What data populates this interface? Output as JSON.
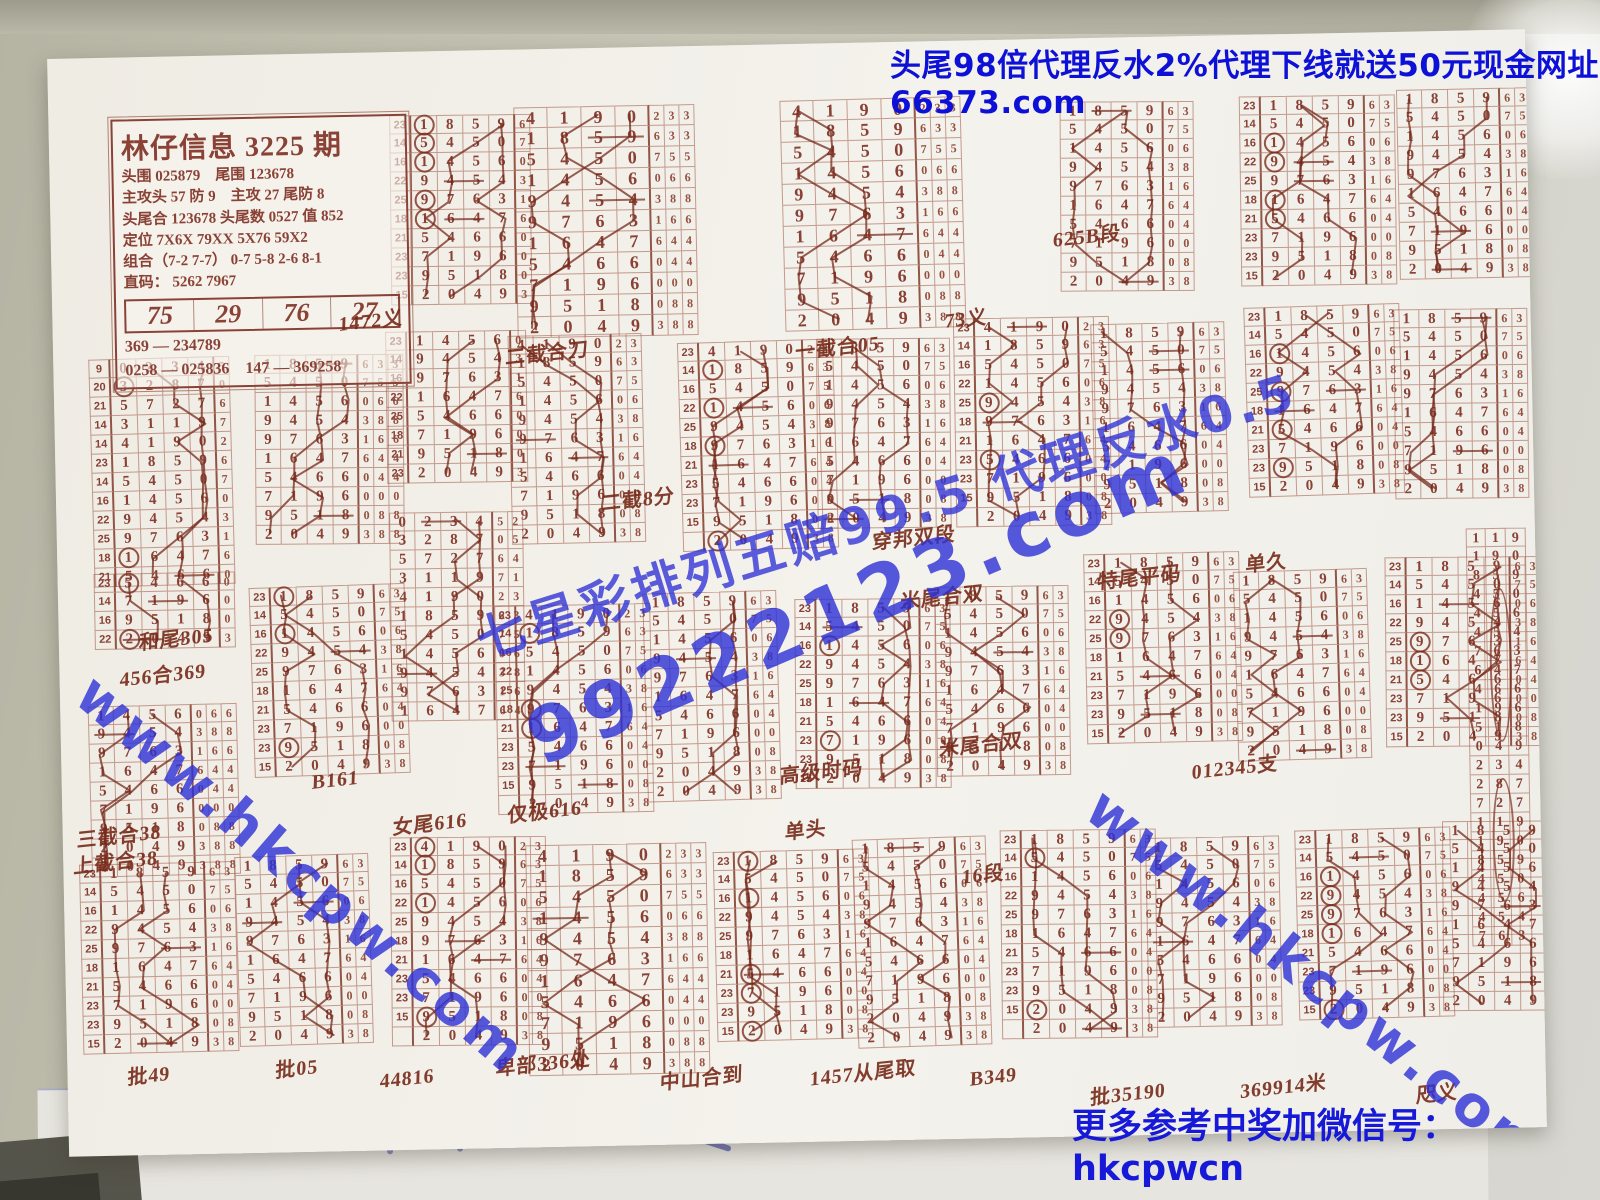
{
  "ad_banner": {
    "text": "头尾98倍代理反水2%代理下线就送50元现金网址66373.com",
    "color": "#0d10d6"
  },
  "footer": {
    "text": "更多参考中奖加微信号：hkcpwcn",
    "color": "#161ad8"
  },
  "watermarks": [
    {
      "name": "promo-odds",
      "text": "七星彩排列五赔99.5 代理反水0.5",
      "color": "#2e31d6"
    },
    {
      "name": "site-number",
      "text": "99222123.com",
      "color": "#2e31d6"
    },
    {
      "name": "site-left",
      "text": "www.hkcpw.com",
      "color": "#2e31d6"
    },
    {
      "name": "site-right",
      "text": "www.hkcpw.com",
      "color": "#2e31d6"
    }
  ],
  "info_box": {
    "title": "林仔信息 3225 期",
    "lines": [
      "头围 025879　尾围 123678",
      "主攻头 57 防 9　主攻 27 尾防 8",
      "头尾合 123678 头尾数 0527 值 852",
      "定位 7X6X  79XX  5X76  59X2",
      "组合（7-2 7-7） 0-7 5-8 2-6 8-1",
      "直码： 5262  7967"
    ],
    "row_numbers": [
      "75",
      "29",
      "76",
      "27"
    ],
    "footer_lines": [
      "369 — 234789",
      "0258 — 025836　147 — 369258"
    ]
  },
  "under_sheet": {
    "faint_digits": "5 5 5 5"
  },
  "chart": {
    "ink_color": "#8a4135",
    "hand_color": "#76291b",
    "row_labels": [
      "23",
      "14",
      "16",
      "22",
      "25",
      "18",
      "21",
      "23",
      "23",
      "15"
    ],
    "extended_labels": [
      "9",
      "20",
      "21",
      "14",
      "14",
      "23",
      "14",
      "16",
      "22",
      "25",
      "18",
      "21"
    ],
    "sequence": [
      {
        "d": [
          "0",
          "2",
          "3",
          "4"
        ],
        "t": [
          "5",
          "2"
        ]
      },
      {
        "d": [
          "3",
          "2",
          "8",
          "7"
        ],
        "t": [
          "0",
          "5"
        ]
      },
      {
        "d": [
          "5",
          "7",
          "2",
          "7"
        ],
        "t": [
          "6",
          "4"
        ]
      },
      {
        "d": [
          "3",
          "1",
          "1",
          "9"
        ],
        "t": [
          "7",
          "1"
        ]
      },
      {
        "d": [
          "4",
          "1",
          "9",
          "0"
        ],
        "t": [
          "2",
          "3"
        ]
      },
      {
        "d": [
          "1",
          "8",
          "5",
          "9"
        ],
        "t": [
          "6",
          "3"
        ]
      },
      {
        "d": [
          "5",
          "4",
          "5",
          "0"
        ],
        "t": [
          "7",
          "5"
        ]
      },
      {
        "d": [
          "1",
          "4",
          "5",
          "6"
        ],
        "t": [
          "0",
          "6"
        ]
      },
      {
        "d": [
          "9",
          "4",
          "5",
          "4"
        ],
        "t": [
          "3",
          "8"
        ]
      },
      {
        "d": [
          "9",
          "7",
          "6",
          "3"
        ],
        "t": [
          "1",
          "6"
        ]
      },
      {
        "d": [
          "1",
          "6",
          "4",
          "7"
        ],
        "t": [
          "6",
          "4"
        ]
      },
      {
        "d": [
          "5",
          "4",
          "6",
          "6"
        ],
        "t": [
          "0",
          "4"
        ]
      },
      {
        "d": [
          "7",
          "1",
          "9",
          "6"
        ],
        "t": [
          "0",
          "0"
        ]
      },
      {
        "d": [
          "9",
          "5",
          "1",
          "8"
        ],
        "t": [
          "0",
          "8"
        ]
      },
      {
        "d": [
          "2",
          "0",
          "4",
          "9"
        ],
        "t": [
          "3",
          "8",
          "8"
        ]
      }
    ],
    "blocks": [
      {
        "x": 340,
        "y": 64,
        "s": 5,
        "n": 10,
        "lab": 1,
        "tr": 1
      },
      {
        "x": 465,
        "y": 58,
        "s": 4,
        "n": 11,
        "tr": 3,
        "size": "L"
      },
      {
        "x": 732,
        "y": 56,
        "s": 4,
        "n": 11,
        "tr": 3,
        "size": "L"
      },
      {
        "x": 1010,
        "y": 64,
        "s": 5,
        "n": 10,
        "tr": 2
      },
      {
        "x": 1190,
        "y": 62,
        "s": 5,
        "n": 10,
        "lab": 1,
        "tr": 2
      },
      {
        "x": 1348,
        "y": 58,
        "s": 5,
        "n": 10,
        "tr": 2
      },
      {
        "x": 36,
        "y": 301,
        "s": 0,
        "n": 12,
        "lab": 1,
        "ext": 1,
        "tr": 1
      },
      {
        "x": 200,
        "y": 301,
        "s": 5,
        "n": 10,
        "tr": 3
      },
      {
        "x": 332,
        "y": 280,
        "s": 7,
        "n": 8,
        "lab": 1,
        "tr": 1
      },
      {
        "x": 455,
        "y": 286,
        "s": 4,
        "n": 11,
        "tr": 2
      },
      {
        "x": 625,
        "y": 296,
        "s": 4,
        "n": 11,
        "lab": 1,
        "tr": 2
      },
      {
        "x": 762,
        "y": 296,
        "s": 5,
        "n": 10,
        "tr": 2
      },
      {
        "x": 900,
        "y": 278,
        "s": 4,
        "n": 11,
        "lab": 1,
        "tr": 2
      },
      {
        "x": 1038,
        "y": 286,
        "s": 5,
        "n": 10,
        "tr": 2
      },
      {
        "x": 1192,
        "y": 272,
        "s": 5,
        "n": 10,
        "lab": 1,
        "tr": 2
      },
      {
        "x": 1340,
        "y": 278,
        "s": 5,
        "n": 10,
        "tr": 2
      },
      {
        "x": 36,
        "y": 516,
        "s": 11,
        "n": 4,
        "lab": 1,
        "tr": 1
      },
      {
        "x": 28,
        "y": 648,
        "s": 7,
        "n": 9,
        "tr": 3
      },
      {
        "x": 192,
        "y": 532,
        "s": 5,
        "n": 10,
        "lab": 1,
        "tr": 2
      },
      {
        "x": 332,
        "y": 461,
        "s": 0,
        "n": 11,
        "tr": 2
      },
      {
        "x": 436,
        "y": 556,
        "s": 4,
        "n": 11,
        "lab": 1,
        "tr": 2
      },
      {
        "x": 585,
        "y": 546,
        "s": 5,
        "n": 11,
        "tr": 2
      },
      {
        "x": 735,
        "y": 556,
        "s": 5,
        "n": 10,
        "lab": 1,
        "tr": 2
      },
      {
        "x": 876,
        "y": 546,
        "s": 5,
        "n": 10,
        "tr": 2
      },
      {
        "x": 1026,
        "y": 516,
        "s": 5,
        "n": 10,
        "lab": 1,
        "tr": 2
      },
      {
        "x": 1176,
        "y": 536,
        "s": 5,
        "n": 10,
        "tr": 2
      },
      {
        "x": 1326,
        "y": 526,
        "s": 5,
        "n": 10,
        "lab": 1,
        "tr": 2
      },
      {
        "type": "strip",
        "x": 1408,
        "y": 498,
        "n": 22
      },
      {
        "x": 16,
        "y": 806,
        "s": 5,
        "n": 10,
        "lab": 1,
        "tr": 2
      },
      {
        "x": 172,
        "y": 801,
        "s": 5,
        "n": 10,
        "tr": 2
      },
      {
        "x": 326,
        "y": 786,
        "s": 4,
        "n": 11,
        "lab": 1,
        "tr": 2
      },
      {
        "x": 462,
        "y": 796,
        "s": 4,
        "n": 11,
        "tr": 3,
        "size": "L"
      },
      {
        "x": 650,
        "y": 806,
        "s": 5,
        "n": 10,
        "lab": 1,
        "tr": 2
      },
      {
        "x": 790,
        "y": 796,
        "s": 5,
        "n": 11,
        "tr": 2
      },
      {
        "x": 936,
        "y": 791,
        "s": 5,
        "n": 11,
        "lab": 1,
        "tr": 2
      },
      {
        "x": 1082,
        "y": 801,
        "s": 5,
        "n": 10,
        "tr": 2
      },
      {
        "x": 1232,
        "y": 796,
        "s": 5,
        "n": 10,
        "lab": 1,
        "tr": 2
      },
      {
        "x": 1378,
        "y": 791,
        "s": 5,
        "n": 10,
        "tr": 2
      }
    ]
  },
  "annotations": [
    {
      "t": "1472义",
      "x": 286,
      "y": 252
    },
    {
      "t": "二截合刀",
      "x": 452,
      "y": 288
    },
    {
      "t": "一截合05",
      "x": 742,
      "y": 288
    },
    {
      "t": "73义",
      "x": 892,
      "y": 262
    },
    {
      "t": "625B段",
      "x": 1002,
      "y": 182
    },
    {
      "t": "米尾合双",
      "x": 842,
      "y": 540
    },
    {
      "t": "二截8分",
      "x": 545,
      "y": 436
    },
    {
      "t": "穿邦双段",
      "x": 815,
      "y": 480
    },
    {
      "t": "特尾平码",
      "x": 1040,
      "y": 524
    },
    {
      "t": "单久",
      "x": 1188,
      "y": 512
    },
    {
      "t": "和尾305",
      "x": 80,
      "y": 566
    },
    {
      "t": "456合369",
      "x": 60,
      "y": 602
    },
    {
      "t": "三截合38",
      "x": 14,
      "y": 762
    },
    {
      "t": "B161",
      "x": 250,
      "y": 716
    },
    {
      "t": "女尾616",
      "x": 330,
      "y": 756
    },
    {
      "t": "仅极616",
      "x": 445,
      "y": 746
    },
    {
      "t": "高级时码",
      "x": 718,
      "y": 712
    },
    {
      "t": "米尾合双",
      "x": 878,
      "y": 688
    },
    {
      "t": "012345支",
      "x": 1130,
      "y": 716
    },
    {
      "t": "单头",
      "x": 722,
      "y": 770
    },
    {
      "t": "16段",
      "x": 898,
      "y": 818
    },
    {
      "t": "上截合38",
      "x": 10,
      "y": 788
    },
    {
      "t": "批49",
      "x": 60,
      "y": 1002
    },
    {
      "t": "批05",
      "x": 208,
      "y": 998
    },
    {
      "t": "44816",
      "x": 312,
      "y": 1016
    },
    {
      "t": "卑部336处",
      "x": 428,
      "y": 998
    },
    {
      "t": "中山合到",
      "x": 592,
      "y": 1016
    },
    {
      "t": "1457从尾取",
      "x": 742,
      "y": 1014
    },
    {
      "t": "B349",
      "x": 902,
      "y": 1026
    },
    {
      "t": "批35190",
      "x": 1022,
      "y": 1040
    },
    {
      "t": "369914米",
      "x": 1172,
      "y": 1036
    },
    {
      "t": "咫义",
      "x": 1348,
      "y": 1046
    }
  ]
}
